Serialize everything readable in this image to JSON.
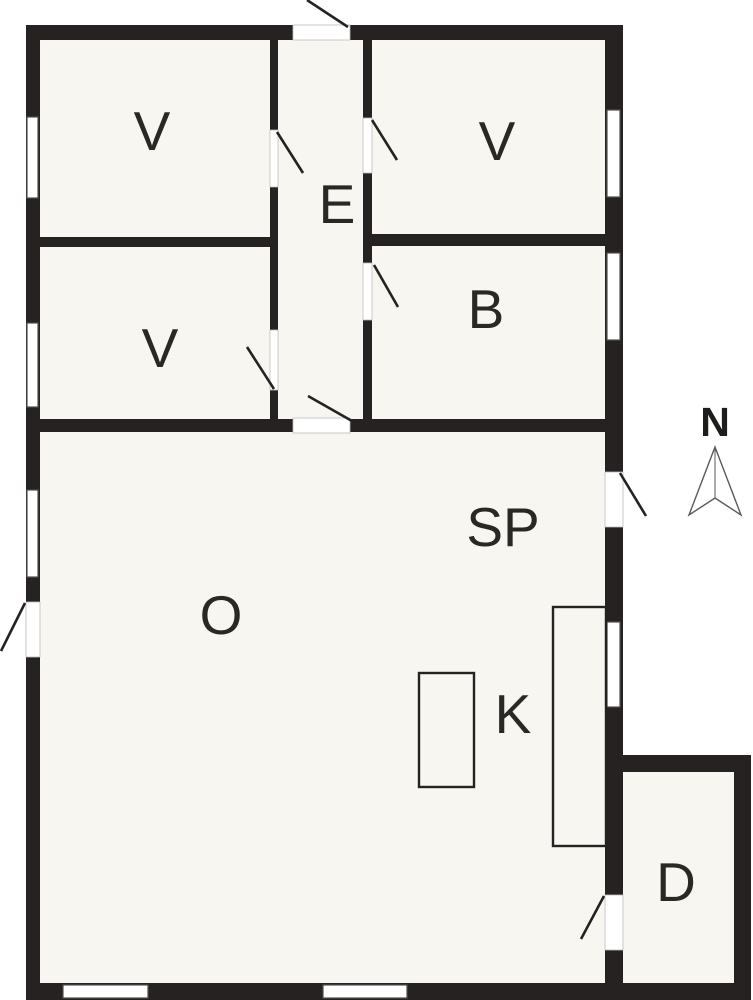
{
  "diagram": {
    "kind_label": "floor-plan",
    "rooms": [
      {
        "id": "room-v-top-left",
        "label": "V"
      },
      {
        "id": "room-v-bottom-left",
        "label": "V"
      },
      {
        "id": "room-v-top-right",
        "label": "V"
      },
      {
        "id": "room-b",
        "label": "B"
      },
      {
        "id": "room-e",
        "label": "E"
      },
      {
        "id": "room-sp",
        "label": "SP"
      },
      {
        "id": "room-o",
        "label": "O"
      },
      {
        "id": "room-k",
        "label": "K"
      },
      {
        "id": "room-d",
        "label": "D"
      }
    ],
    "compass": {
      "label": "N"
    },
    "counts": {
      "windows": 8,
      "doors": 9
    },
    "colors": {
      "wall": "#262221",
      "floor": "#f7f6f1",
      "background": "#ffffff"
    }
  }
}
